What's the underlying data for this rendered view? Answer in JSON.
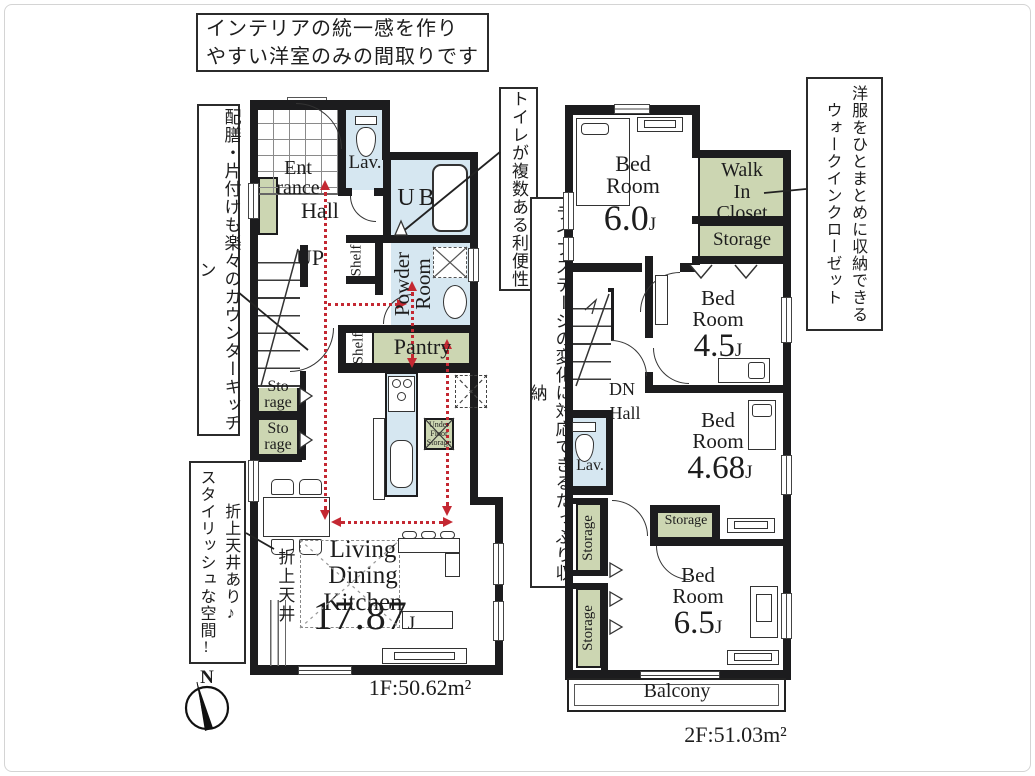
{
  "notes": {
    "top": {
      "line1": "インテリアの統一感を作り",
      "line2": "やすい洋室のみの間取りです"
    },
    "counter": "配膳・片付けも楽々のカウンターキッチン",
    "toilet": "トイレが複数ある利便性",
    "life": "ライフステージの変化に対応できるたっぷり収納",
    "ceiling": {
      "col1": "折上天井あり♪",
      "col2": "スタイリッシュな空間!"
    },
    "wic": {
      "col1": "洋服をひとまとめに収納できる",
      "col2": "ウォークインクローゼット"
    }
  },
  "floor1": {
    "area_label": "1F:50.62m²",
    "entrance": {
      "l1": "Ent",
      "l2": "rance"
    },
    "hall": "Hall",
    "up": "UP",
    "lav": "Lav.",
    "ub": "UB",
    "powder": {
      "l1": "Powder",
      "l2": "Room"
    },
    "shelf1": "Shelf",
    "shelf2": "Shelf",
    "pantry": "Pantry",
    "storage1": {
      "l1": "Sto",
      "l2": "rage"
    },
    "storage2": {
      "l1": "Sto",
      "l2": "rage"
    },
    "under_floor": {
      "l1": "Under",
      "l2": "Floor",
      "l3": "Storage"
    },
    "ldk": {
      "l1": "Living",
      "l2": "Dining",
      "l3": "Kitchen",
      "num": "17.87",
      "unit": "J"
    },
    "ceiling_v": "折上天井"
  },
  "floor2": {
    "area_label": "2F:51.03m²",
    "bed1": {
      "l1": "Bed",
      "l2": "Room",
      "num": "6.0",
      "unit": "J"
    },
    "wic": {
      "l1": "Walk",
      "l2": "In",
      "l3": "Closet"
    },
    "storage_top": "Storage",
    "bed2": {
      "l1": "Bed",
      "l2": "Room",
      "num": "4.5",
      "unit": "J"
    },
    "dn": "DN",
    "hall": "Hall",
    "lav": "Lav.",
    "bed3": {
      "l1": "Bed",
      "l2": "Room",
      "num": "4.68",
      "unit": "J"
    },
    "storage_mid": "Storage",
    "storage_v1": "Storage",
    "storage_v2": "Storage",
    "bed4": {
      "l1": "Bed",
      "l2": "Room",
      "num": "6.5",
      "unit": "J"
    },
    "balcony": "Balcony"
  },
  "compass": {
    "n": "N"
  }
}
